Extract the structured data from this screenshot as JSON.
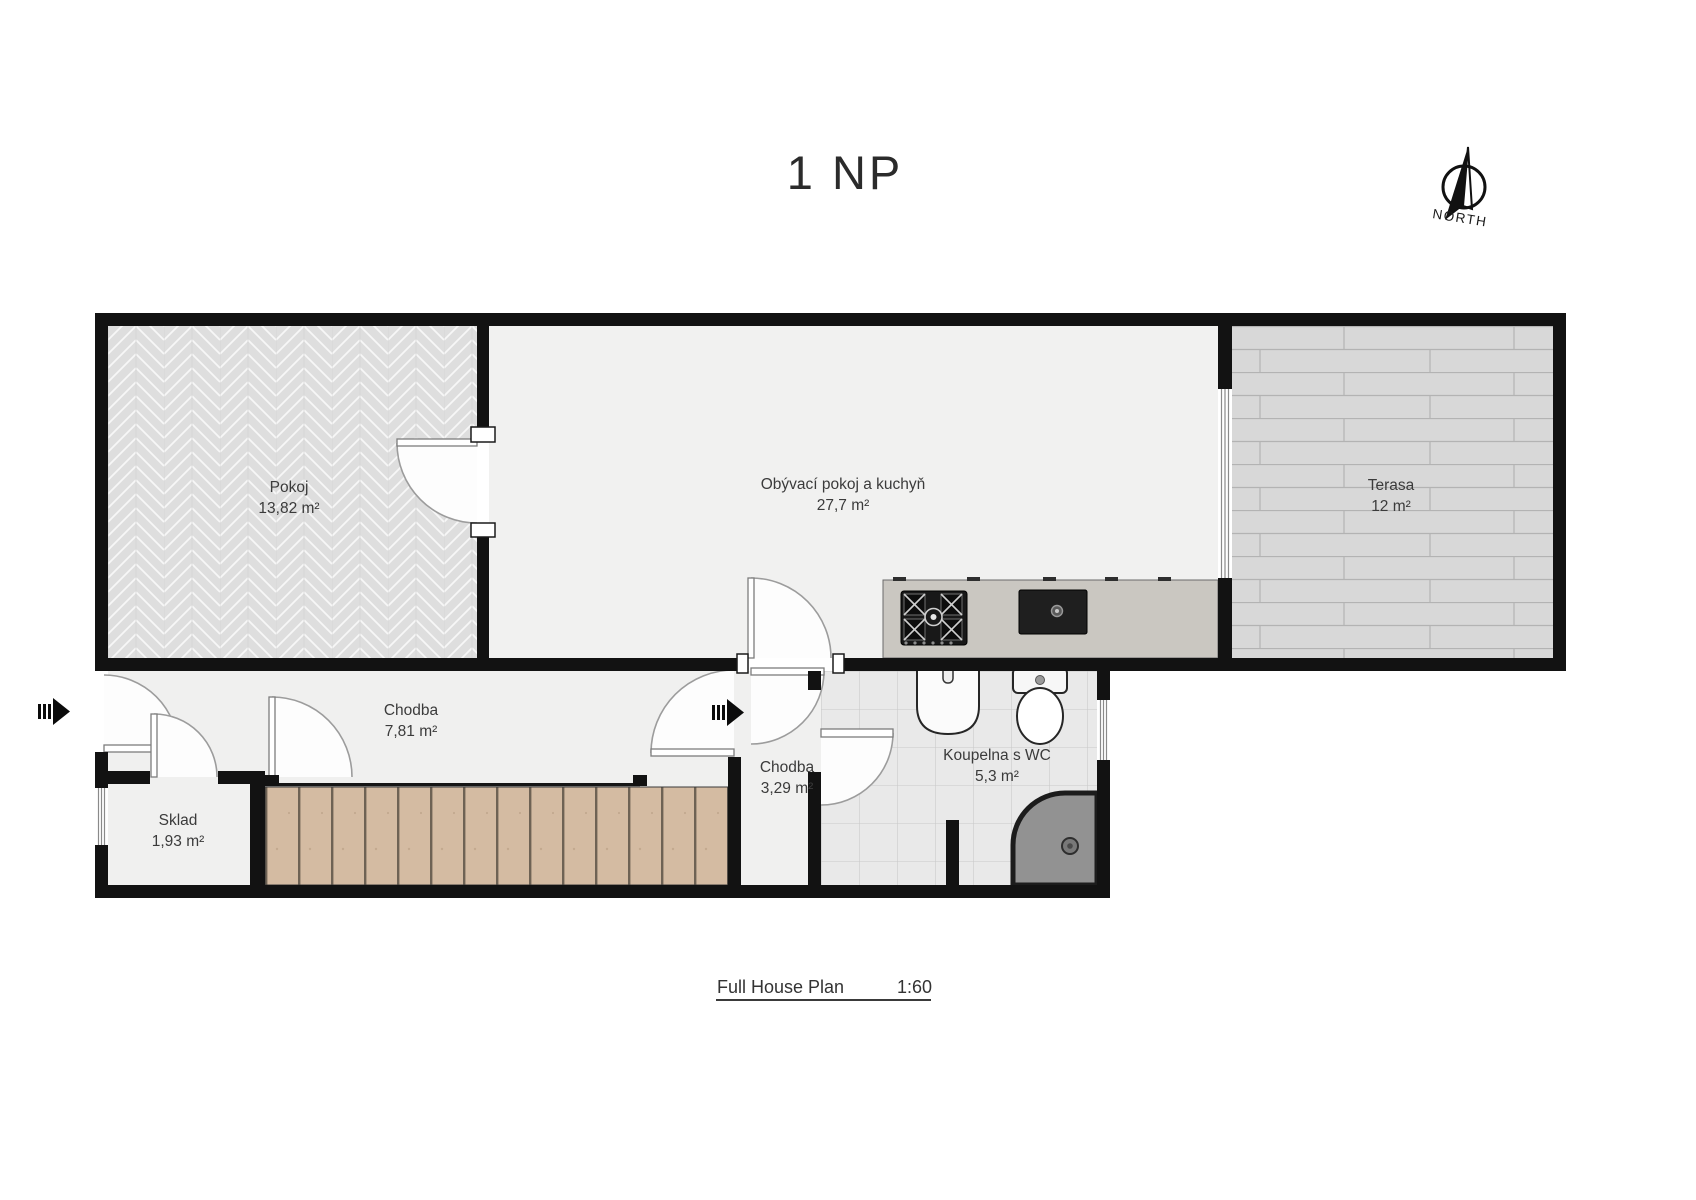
{
  "title": "1 NP",
  "compass": {
    "label": "NORTH"
  },
  "rooms": [
    {
      "id": "pokoj",
      "name": "Pokoj",
      "area": "13,82 m²"
    },
    {
      "id": "living",
      "name": "Obývací pokoj a kuchyň",
      "area": "27,7 m²"
    },
    {
      "id": "terasa",
      "name": "Terasa",
      "area": "12 m²"
    },
    {
      "id": "chodba1",
      "name": "Chodba",
      "area": "7,81 m²"
    },
    {
      "id": "chodba2",
      "name": "Chodba",
      "area": "3,29 m²"
    },
    {
      "id": "koupelna",
      "name": "Koupelna s WC",
      "area": "5,3 m²"
    },
    {
      "id": "sklad",
      "name": "Sklad",
      "area": "1,93 m²"
    }
  ],
  "footer": {
    "label": "Full House Plan",
    "scale": "1:60"
  },
  "colors": {
    "wall": "#121212",
    "stair_wood": "#d4bba2",
    "terrace_deck": "#d8d8d8",
    "bath_tile": "#e9e9e9",
    "shower": "#929292",
    "counter": "#cac7c1"
  }
}
